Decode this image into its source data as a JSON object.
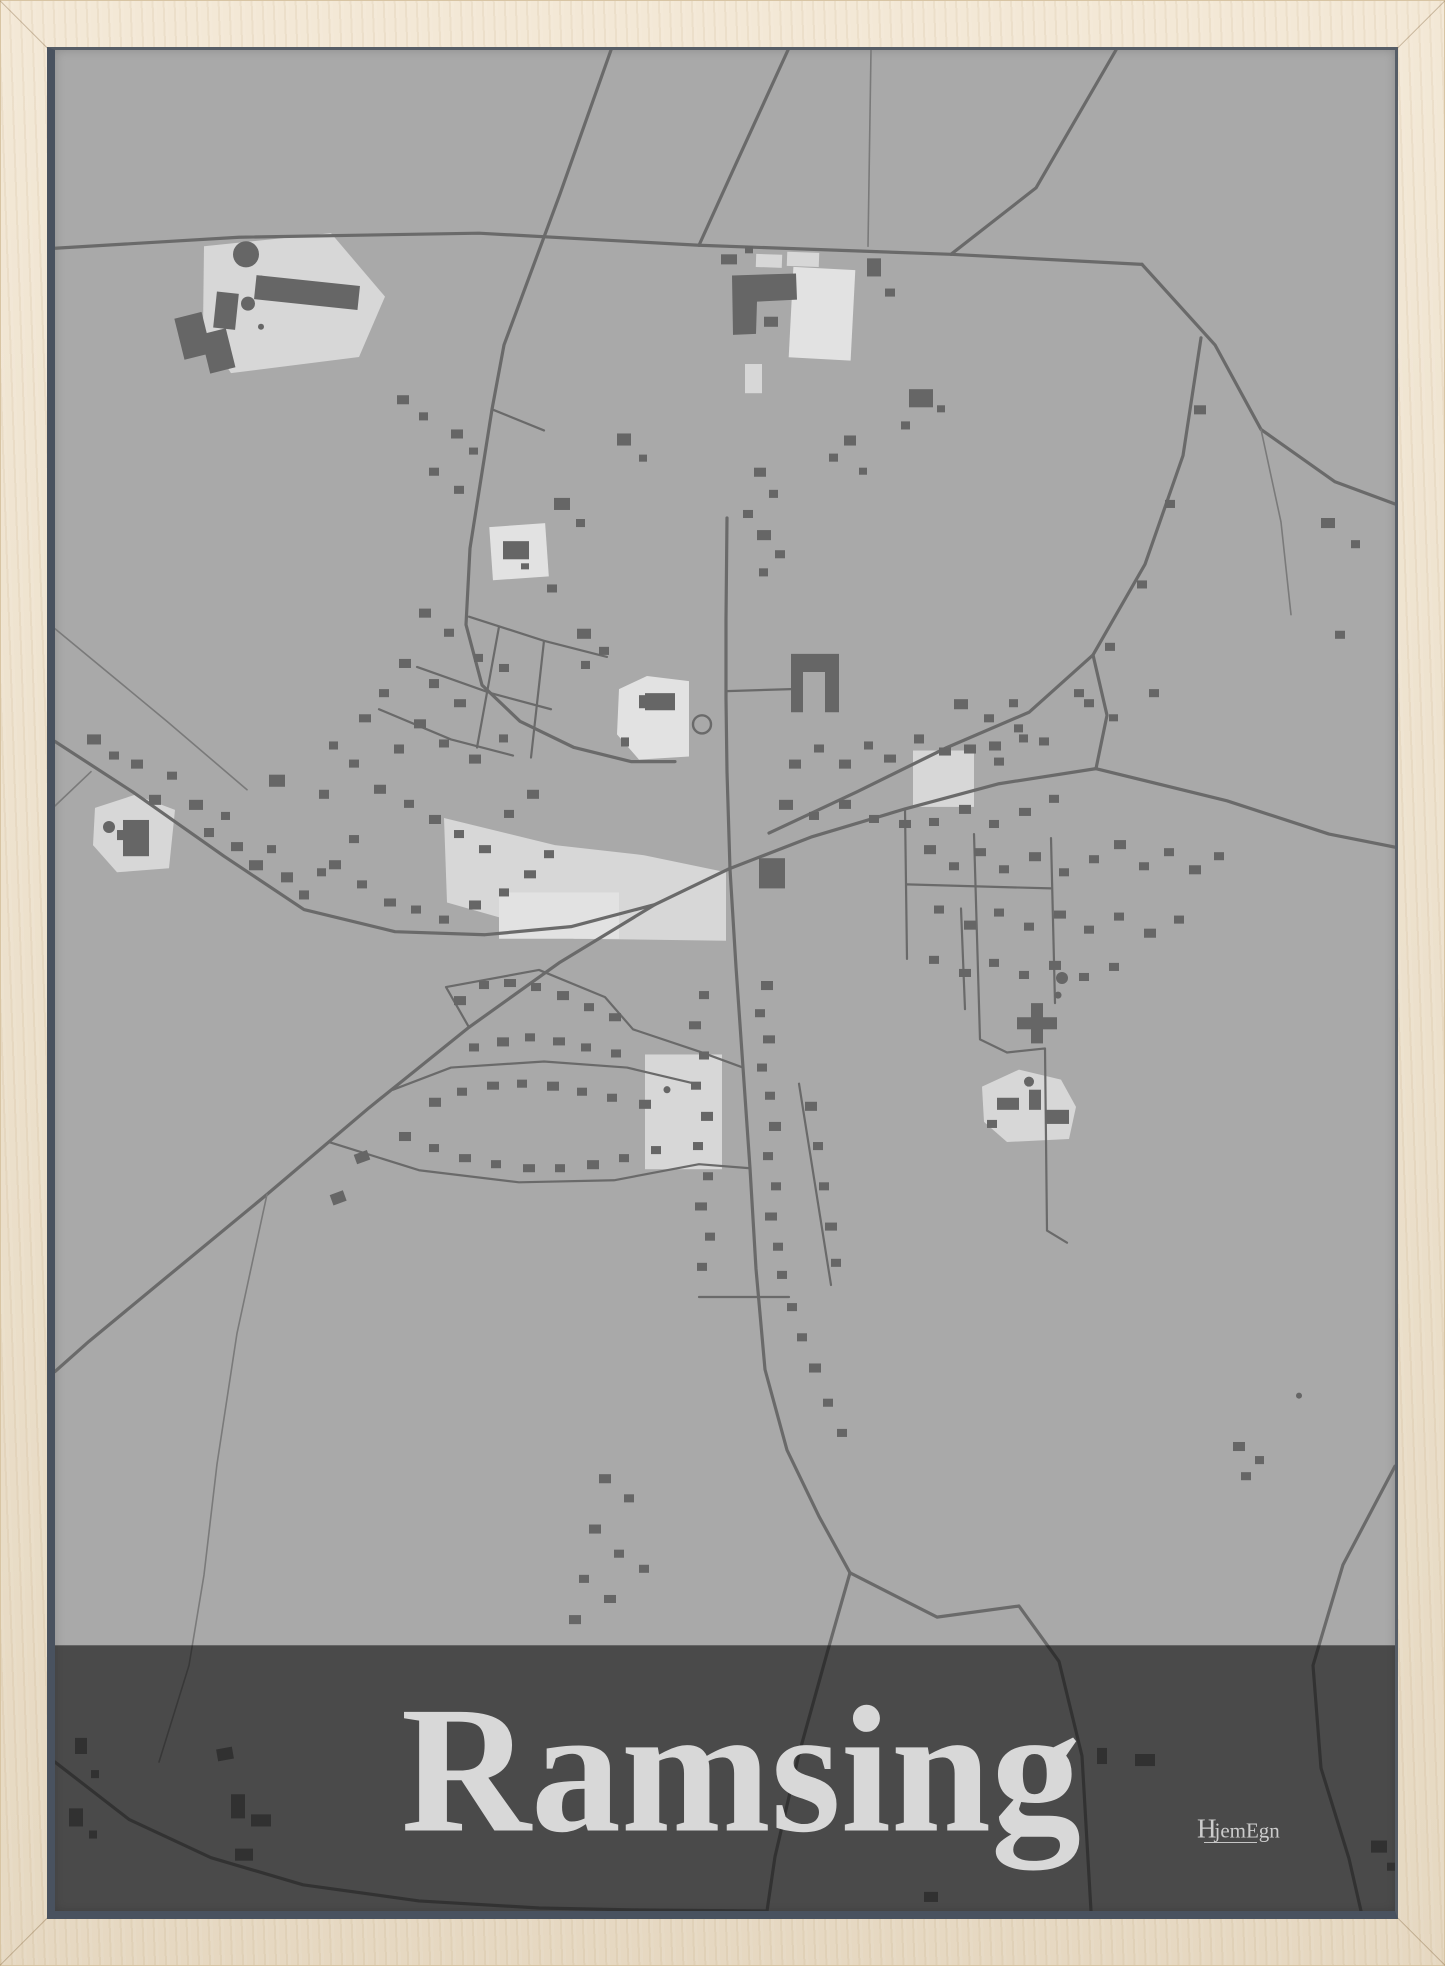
{
  "poster": {
    "title": "Ramsing",
    "brand": {
      "initial": "H",
      "rest": "jemEgn",
      "full": "HjemEgn"
    },
    "colors": {
      "bg": "#a9a9a9",
      "roads": "#6a6a6a",
      "roads-thin": "#7a7a7a",
      "buildings": "#666666",
      "light": "#d7d7d7",
      "lighter": "#e2e2e2",
      "band": "rgba(16,16,16,0.62)",
      "title": "#d8d8d8",
      "wood": "#efe1c9",
      "lip": "#49525f"
    }
  }
}
